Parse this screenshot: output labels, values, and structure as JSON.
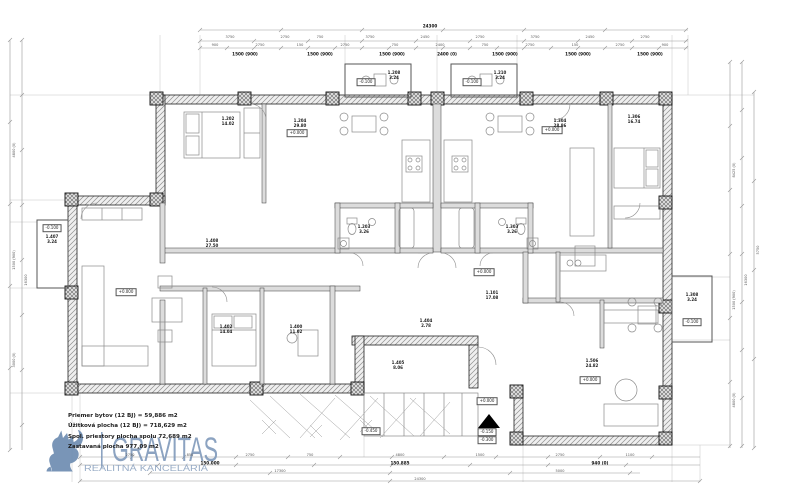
{
  "watermark": {
    "brand": "GRAVITAS",
    "tagline": "REALITNÁ KANCELÁRIA",
    "brand_color": "#7d97b9"
  },
  "summary": {
    "lines": [
      "Priemer bytov (12 BJ) = 59,886 m2",
      "Úžitková plocha (12 BJ) = 718,629 m2",
      "Spol. priestory plocha spolu 72,689 m2",
      "Zastavaná plocha 977,09 m2"
    ]
  },
  "room_labels": [
    {
      "id": "1.202",
      "area": "14.02",
      "x": 228,
      "y": 122
    },
    {
      "id": "1.204",
      "area": "29.80",
      "x": 300,
      "y": 124
    },
    {
      "id": "1.304",
      "area": "28.86",
      "x": 560,
      "y": 124
    },
    {
      "id": "1.306",
      "area": "16.74",
      "x": 634,
      "y": 120
    },
    {
      "id": "1.208",
      "area": "3.24",
      "x": 394,
      "y": 76
    },
    {
      "id": "1.210",
      "area": "3.24",
      "x": 500,
      "y": 76
    },
    {
      "id": "1.407",
      "area": "3.24",
      "x": 52,
      "y": 240
    },
    {
      "id": "1.308",
      "area": "3.24",
      "x": 692,
      "y": 298
    },
    {
      "id": "1.408",
      "area": "27.50",
      "x": 212,
      "y": 244
    },
    {
      "id": "1.402",
      "area": "14.04",
      "x": 226,
      "y": 330
    },
    {
      "id": "1.400",
      "area": "11.02",
      "x": 296,
      "y": 330
    },
    {
      "id": "1.404",
      "area": "2.78",
      "x": 426,
      "y": 324
    },
    {
      "id": "1.405",
      "area": "8.06",
      "x": 398,
      "y": 366
    },
    {
      "id": "1.101",
      "area": "17.08",
      "x": 492,
      "y": 296
    },
    {
      "id": "1.506",
      "area": "24.82",
      "x": 592,
      "y": 364
    },
    {
      "id": "1.203",
      "area": "3.26",
      "x": 364,
      "y": 230
    },
    {
      "id": "1.303",
      "area": "3.26",
      "x": 512,
      "y": 230
    }
  ],
  "elevation_markers": [
    {
      "t": "-0.100",
      "x": 366,
      "y": 82
    },
    {
      "t": "-0.100",
      "x": 472,
      "y": 82
    },
    {
      "t": "-0.100",
      "x": 52,
      "y": 228
    },
    {
      "t": "-0.100",
      "x": 692,
      "y": 322
    },
    {
      "t": "+0.000",
      "x": 297,
      "y": 133
    },
    {
      "t": "+0.000",
      "x": 552,
      "y": 130
    },
    {
      "t": "+0.000",
      "x": 126,
      "y": 292
    },
    {
      "t": "+0.000",
      "x": 484,
      "y": 272
    },
    {
      "t": "+0.000",
      "x": 590,
      "y": 380
    },
    {
      "t": "+0.000",
      "x": 487,
      "y": 401
    },
    {
      "t": "-0.150",
      "x": 487,
      "y": 432
    },
    {
      "t": "-0.300",
      "x": 487,
      "y": 440
    },
    {
      "t": "-0.450",
      "x": 371,
      "y": 431
    }
  ],
  "dim_labels": [
    {
      "t": "24300",
      "x": 430,
      "y": 26,
      "b": 1
    },
    {
      "t": "3750",
      "x": 230,
      "y": 37
    },
    {
      "t": "2750",
      "x": 285,
      "y": 37
    },
    {
      "t": "750",
      "x": 320,
      "y": 37
    },
    {
      "t": "3750",
      "x": 370,
      "y": 37
    },
    {
      "t": "2450",
      "x": 425,
      "y": 37
    },
    {
      "t": "2750",
      "x": 480,
      "y": 37
    },
    {
      "t": "3750",
      "x": 535,
      "y": 37
    },
    {
      "t": "2450",
      "x": 590,
      "y": 37
    },
    {
      "t": "2750",
      "x": 645,
      "y": 37
    },
    {
      "t": "900",
      "x": 215,
      "y": 45
    },
    {
      "t": "2750",
      "x": 260,
      "y": 45
    },
    {
      "t": "150",
      "x": 300,
      "y": 45
    },
    {
      "t": "2750",
      "x": 345,
      "y": 45
    },
    {
      "t": "750",
      "x": 395,
      "y": 45
    },
    {
      "t": "2400",
      "x": 440,
      "y": 45
    },
    {
      "t": "750",
      "x": 485,
      "y": 45
    },
    {
      "t": "2750",
      "x": 530,
      "y": 45
    },
    {
      "t": "150",
      "x": 575,
      "y": 45
    },
    {
      "t": "2750",
      "x": 620,
      "y": 45
    },
    {
      "t": "900",
      "x": 665,
      "y": 45
    },
    {
      "t": "1500 (900)",
      "x": 245,
      "y": 54,
      "b": 1
    },
    {
      "t": "1500 (900)",
      "x": 320,
      "y": 54,
      "b": 1
    },
    {
      "t": "1500 (900)",
      "x": 392,
      "y": 54,
      "b": 1
    },
    {
      "t": "2400 (0)",
      "x": 447,
      "y": 54,
      "b": 1
    },
    {
      "t": "1500 (900)",
      "x": 505,
      "y": 54,
      "b": 1
    },
    {
      "t": "1500 (900)",
      "x": 578,
      "y": 54,
      "b": 1
    },
    {
      "t": "1500 (900)",
      "x": 650,
      "y": 54,
      "b": 1
    },
    {
      "t": "4800 (0)",
      "x": 14,
      "y": 150,
      "r": 1
    },
    {
      "t": "1500 (900)",
      "x": 14,
      "y": 260,
      "r": 1
    },
    {
      "t": "3000 (0)",
      "x": 14,
      "y": 360,
      "r": 1
    },
    {
      "t": "16300",
      "x": 26,
      "y": 280,
      "r": 1
    },
    {
      "t": "8425 (0)",
      "x": 734,
      "y": 170,
      "r": 1
    },
    {
      "t": "1500 (900)",
      "x": 734,
      "y": 300,
      "r": 1
    },
    {
      "t": "4800 (0)",
      "x": 734,
      "y": 400,
      "r": 1
    },
    {
      "t": "16300",
      "x": 746,
      "y": 280,
      "r": 1
    },
    {
      "t": "5750",
      "x": 758,
      "y": 250,
      "r": 1
    },
    {
      "t": "2750",
      "x": 130,
      "y": 455
    },
    {
      "t": "850",
      "x": 190,
      "y": 455
    },
    {
      "t": "2750",
      "x": 250,
      "y": 455
    },
    {
      "t": "750",
      "x": 310,
      "y": 455
    },
    {
      "t": "4800",
      "x": 400,
      "y": 455
    },
    {
      "t": "1500",
      "x": 480,
      "y": 455
    },
    {
      "t": "2750",
      "x": 560,
      "y": 455
    },
    {
      "t": "1100",
      "x": 630,
      "y": 455
    },
    {
      "t": "150.000",
      "x": 210,
      "y": 463,
      "b": 1
    },
    {
      "t": "150.885",
      "x": 400,
      "y": 463,
      "b": 1
    },
    {
      "t": "940 (0)",
      "x": 600,
      "y": 463,
      "b": 1
    },
    {
      "t": "17300",
      "x": 280,
      "y": 471
    },
    {
      "t": "5000",
      "x": 560,
      "y": 471
    },
    {
      "t": "24300",
      "x": 420,
      "y": 479
    }
  ]
}
